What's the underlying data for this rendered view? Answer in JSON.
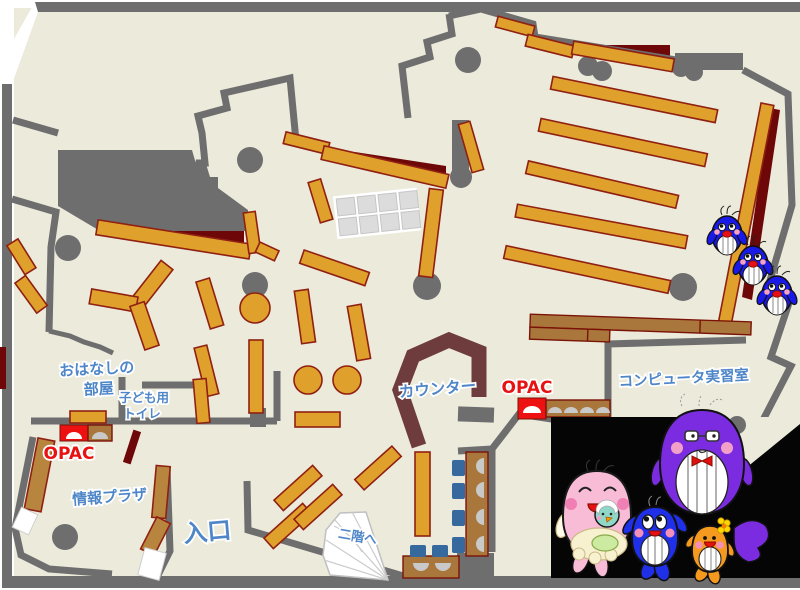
{
  "map": {
    "kind": "library-first-floor-plan",
    "labels": {
      "storytelling_room_line1": "おはなしの",
      "storytelling_room_line2": "部屋",
      "kids_toilet_line1": "子ども用",
      "kids_toilet_line2": "トイレ",
      "opac_left": "OPAC",
      "opac_right": "OPAC",
      "info_plaza": "情報プラザ",
      "entrance": "入口",
      "counter": "カウンター",
      "computer_room": "コンピュータ実習室",
      "to_second_floor": "二階へ"
    },
    "colors": {
      "floor": "#eceadb",
      "wall_gray": "#6e6e6e",
      "shelf_orange": "#e0a02c",
      "shelf_outline_maroon": "#8f2012",
      "desk_brown": "#a9763b",
      "plaza_shelf_tan": "#b8853f",
      "counter_maroon": "#6e3c3c",
      "accent_dark_red": "#6e0808",
      "chair_blue": "#36699e",
      "label_blue": "#4e86c8",
      "label_red": "#e81212",
      "opac_station_red": "#ee1111",
      "mascot_panel_black": "#050505"
    },
    "mascots": {
      "blue_chicks_count": 3,
      "blue_chick_color": "#1a1ae8",
      "whale_family": [
        {
          "name": "pink-mother-whale",
          "color": "#f9bcd6"
        },
        {
          "name": "teal-baby-whale",
          "color": "#8fd8c8"
        },
        {
          "name": "blue-child-whale",
          "color": "#2030e8"
        },
        {
          "name": "purple-father-whale",
          "color": "#7c2ce0"
        },
        {
          "name": "orange-child-whale",
          "color": "#f59a1e"
        }
      ]
    }
  }
}
